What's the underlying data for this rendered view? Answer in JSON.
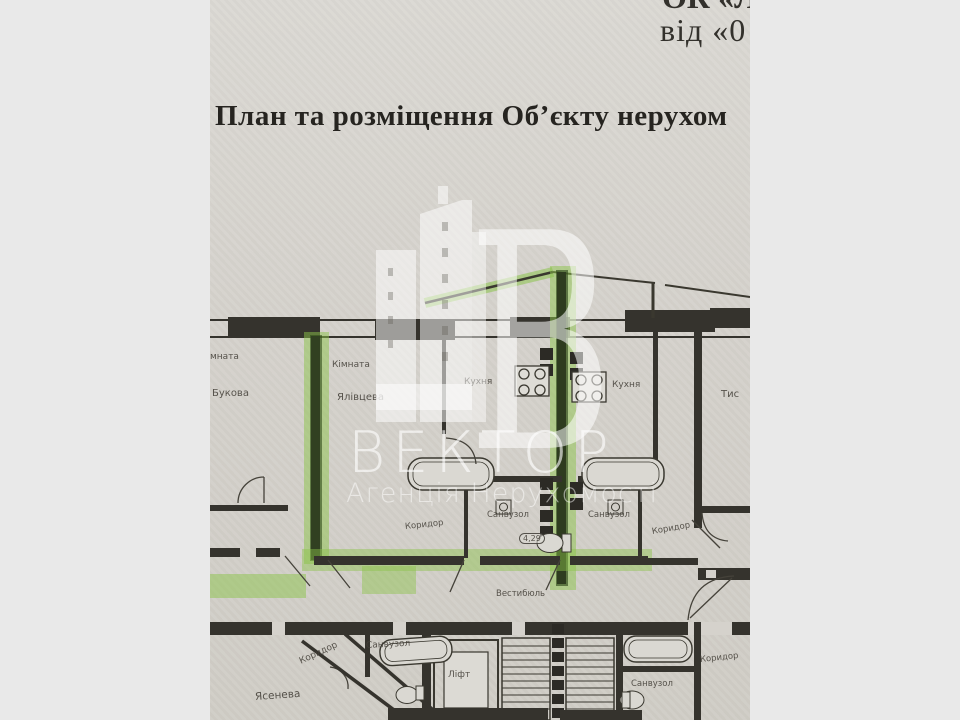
{
  "header": {
    "line1_partial": "ОК «Л",
    "line2_partial": "від «0"
  },
  "title": "План та розміщення Об’єкту нерухом",
  "watermark": {
    "logo_letter": "В",
    "name": "ВЕКТОР",
    "subtitle": "Агенція Нерухомості"
  },
  "plan": {
    "room_left_name_partial": "мната",
    "room_left_street": "Букова",
    "room_mid_name": "Кімната",
    "room_mid_street": "Ялівцева",
    "kitchen_left": "Кухня",
    "kitchen_right": "Кухня",
    "room_right_partial": "Тис",
    "corridor_top_left": "Коридор",
    "bath_top_left": "Санвузол",
    "bath_top_right": "Санвузол",
    "corridor_top_right": "Коридор",
    "area_value": "4,29",
    "vestibule": "Вестибюль",
    "bath_bottom_left": "Санвузол",
    "corridor_bottom_left": "Коридор",
    "room_bottom_street": "Ясенева",
    "elevator": "Ліфт",
    "bath_bottom_right": "Санвузол",
    "corridor_bottom_right": "Коридор"
  },
  "colors": {
    "highlight_green": "#8bc34a",
    "wall_dark": "#35332d",
    "paper": "#d6d4ce",
    "backdrop": "#e9e9e9"
  }
}
